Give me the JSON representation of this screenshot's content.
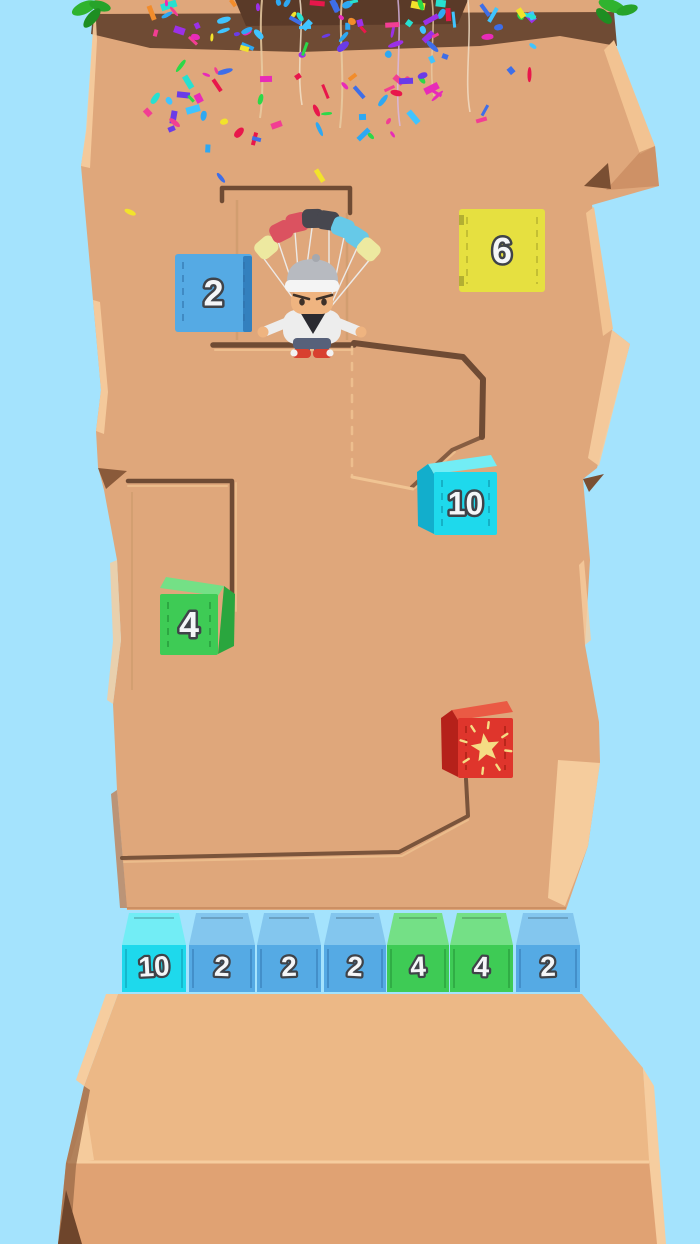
{
  "game": {
    "sky_color": "#A4E3FD",
    "floating_blocks": [
      {
        "label": "2",
        "color": "blue",
        "x": 175,
        "y": 254,
        "w": 77,
        "h": 78,
        "style": "flat"
      },
      {
        "label": "6",
        "color": "yellow",
        "x": 459,
        "y": 209,
        "w": 86,
        "h": 83,
        "style": "flat"
      },
      {
        "label": "10",
        "color": "cyan",
        "x": 417,
        "y": 455,
        "w": 80,
        "h": 80,
        "style": "3d-left"
      },
      {
        "label": "4",
        "color": "green",
        "x": 160,
        "y": 577,
        "w": 75,
        "h": 78,
        "style": "3d-right"
      },
      {
        "label": "",
        "icon": "star-icon",
        "color": "red",
        "x": 441,
        "y": 701,
        "w": 72,
        "h": 77,
        "style": "3d-left"
      }
    ],
    "bottom_row_y": 913,
    "bottom_row_blocks": [
      {
        "label": "10",
        "color": "cyan",
        "x": 122,
        "w": 64
      },
      {
        "label": "2",
        "color": "blue",
        "x": 189,
        "w": 66
      },
      {
        "label": "2",
        "color": "blue",
        "x": 257,
        "w": 64
      },
      {
        "label": "2",
        "color": "blue",
        "x": 324,
        "w": 62
      },
      {
        "label": "4",
        "color": "green",
        "x": 387,
        "w": 62
      },
      {
        "label": "4",
        "color": "green",
        "x": 450,
        "w": 63
      },
      {
        "label": "2",
        "color": "blue",
        "x": 516,
        "w": 64
      }
    ],
    "block_colors": {
      "blue": {
        "front": "#55AAE4",
        "top": "#83C6EE",
        "side": "#3380BE",
        "dash": "#2F6FA8"
      },
      "cyan": {
        "front": "#1ED9EC",
        "top": "#72EDF5",
        "side": "#12AECC",
        "dash": "#0E8FA8"
      },
      "green": {
        "front": "#3ECB55",
        "top": "#74E086",
        "side": "#2AA63E",
        "dash": "#1F8A33"
      },
      "yellow": {
        "front": "#E6E040",
        "top": "#F0EB76",
        "side": "#BDB82E",
        "dash": "#A8A428"
      },
      "red": {
        "front": "#DF352C",
        "top": "#EA5A44",
        "side": "#B5211A",
        "dash": "#99190F"
      }
    },
    "number_text": {
      "fill": "#F4F6F8",
      "outline": "#3F4349"
    },
    "star_color": "#F5DC84",
    "confetti_colors": [
      "#E8174B",
      "#F23E93",
      "#9B30E8",
      "#6A3BE8",
      "#3E6EE8",
      "#2EA8F2",
      "#27E0D0",
      "#2BD948",
      "#F2E32B",
      "#F28C2B",
      "#E82BB8",
      "#40C4FF"
    ],
    "character": {
      "cap_color": "#B7BAC0",
      "cap_knob": "#A5A8AE",
      "band_color": "#F4F4F4",
      "skin": "#EFB480",
      "shirt": "#EDEDED",
      "chest": "#2A2A30",
      "pants": "#57617A",
      "shoe": "#D8402F",
      "shoe_tip": "#F2F2F2",
      "string_color": "#EDEDED",
      "eye_color": "#3E3128",
      "parachute_colors": [
        "#EDE9A0",
        "#DB5260",
        "#DB5260",
        "#47474F",
        "#47474F",
        "#66C9E8",
        "#66C9E8",
        "#EDE9A0"
      ]
    },
    "rock": {
      "face": "#DFA77B",
      "light": "#F2C392",
      "lighter": "#F6CD9F",
      "dark": "#C08055",
      "band": "#6F4B34",
      "deep": "#5A3A28",
      "groove": "#6F4B34",
      "groove_light": "#F0C493",
      "ped_top": "#ECB886",
      "ped_front": "#E0A273",
      "shadow": "#8A5A3A",
      "deep_corner": "#6E452B"
    },
    "leaves": {
      "green": "#2FB32F",
      "mid_green": "#27A32A",
      "dark_green": "#1E8E22"
    },
    "streamer_colors": [
      "#E9CBA2",
      "#F2E0C8",
      "#E9CBA2",
      "#D9B8E8",
      "#E9CBA2",
      "#F2E0C8"
    ]
  }
}
